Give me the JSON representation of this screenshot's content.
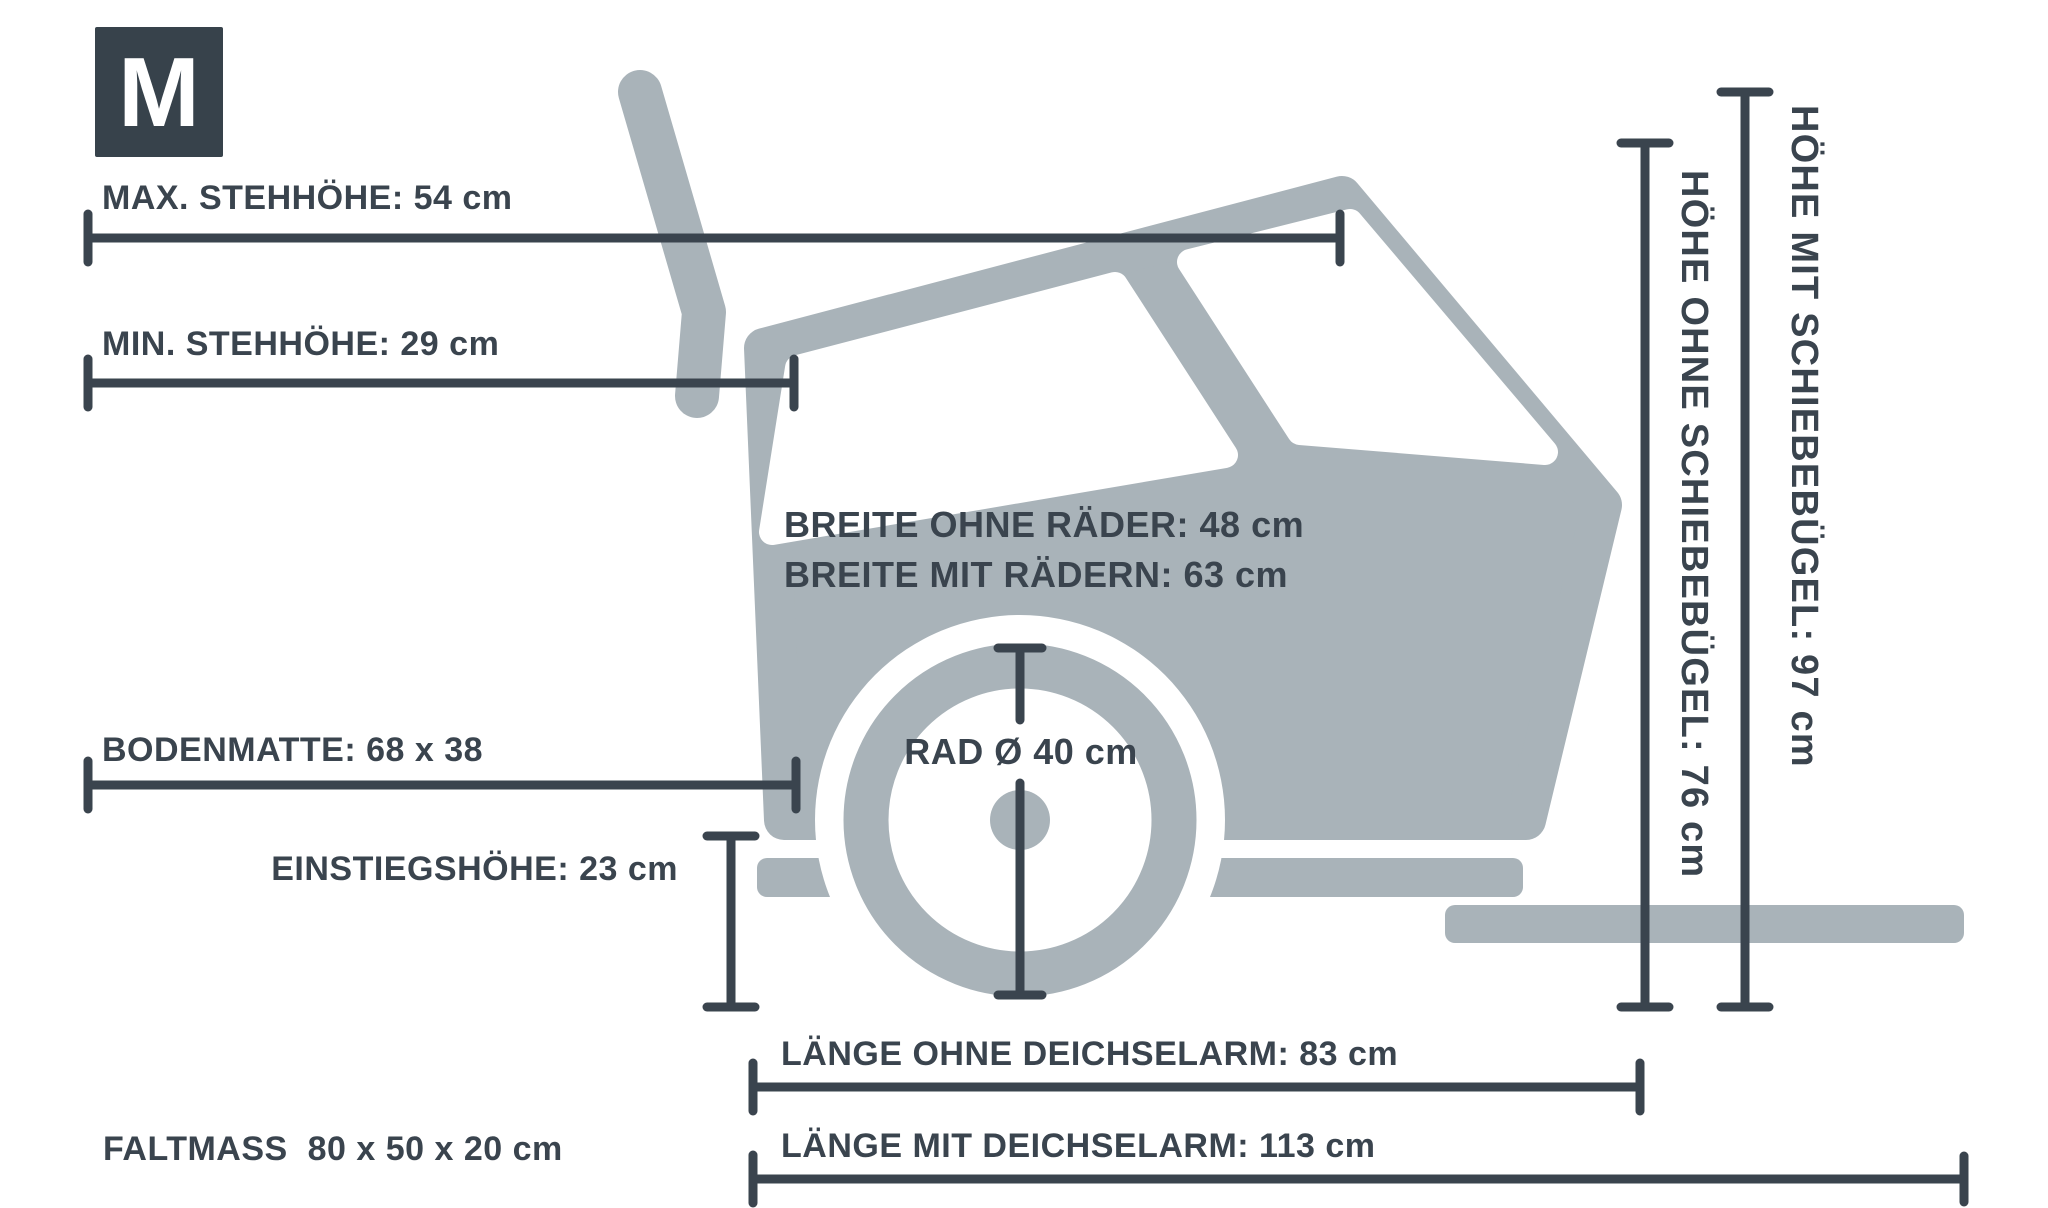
{
  "badge": {
    "label": "M"
  },
  "colors": {
    "ink": "#3a444e",
    "shape_gray": "#a9b3b9",
    "background": "#ffffff"
  },
  "measurements": {
    "max_stehhoehe": "MAX. STEHHÖHE: 54 cm",
    "min_stehhoehe": "MIN. STEHHÖHE: 29 cm",
    "breite_ohne_raeder": "BREITE OHNE RÄDER: 48 cm",
    "breite_mit_raedern": "BREITE MIT RÄDERN: 63 cm",
    "bodenmatte": "BODENMATTE: 68 x 38",
    "rad_durchmesser": "RAD Ø 40 cm",
    "einstiegshoehe": "EINSTIEGSHÖHE: 23 cm",
    "laenge_ohne_deichselarm": "LÄNGE OHNE DEICHSELARM: 83 cm",
    "laenge_mit_deichselarm": "LÄNGE MIT DEICHSELARM: 113 cm",
    "faltmass": "FALTMASS  80 x 50 x 20 cm",
    "hoehe_ohne_schiebebuegel": "HÖHE OHNE SCHIEBEBÜGEL: 76 cm",
    "hoehe_mit_schiebebuegel": "HÖHE MIT SCHIEBEBÜGEL: 97 cm"
  }
}
